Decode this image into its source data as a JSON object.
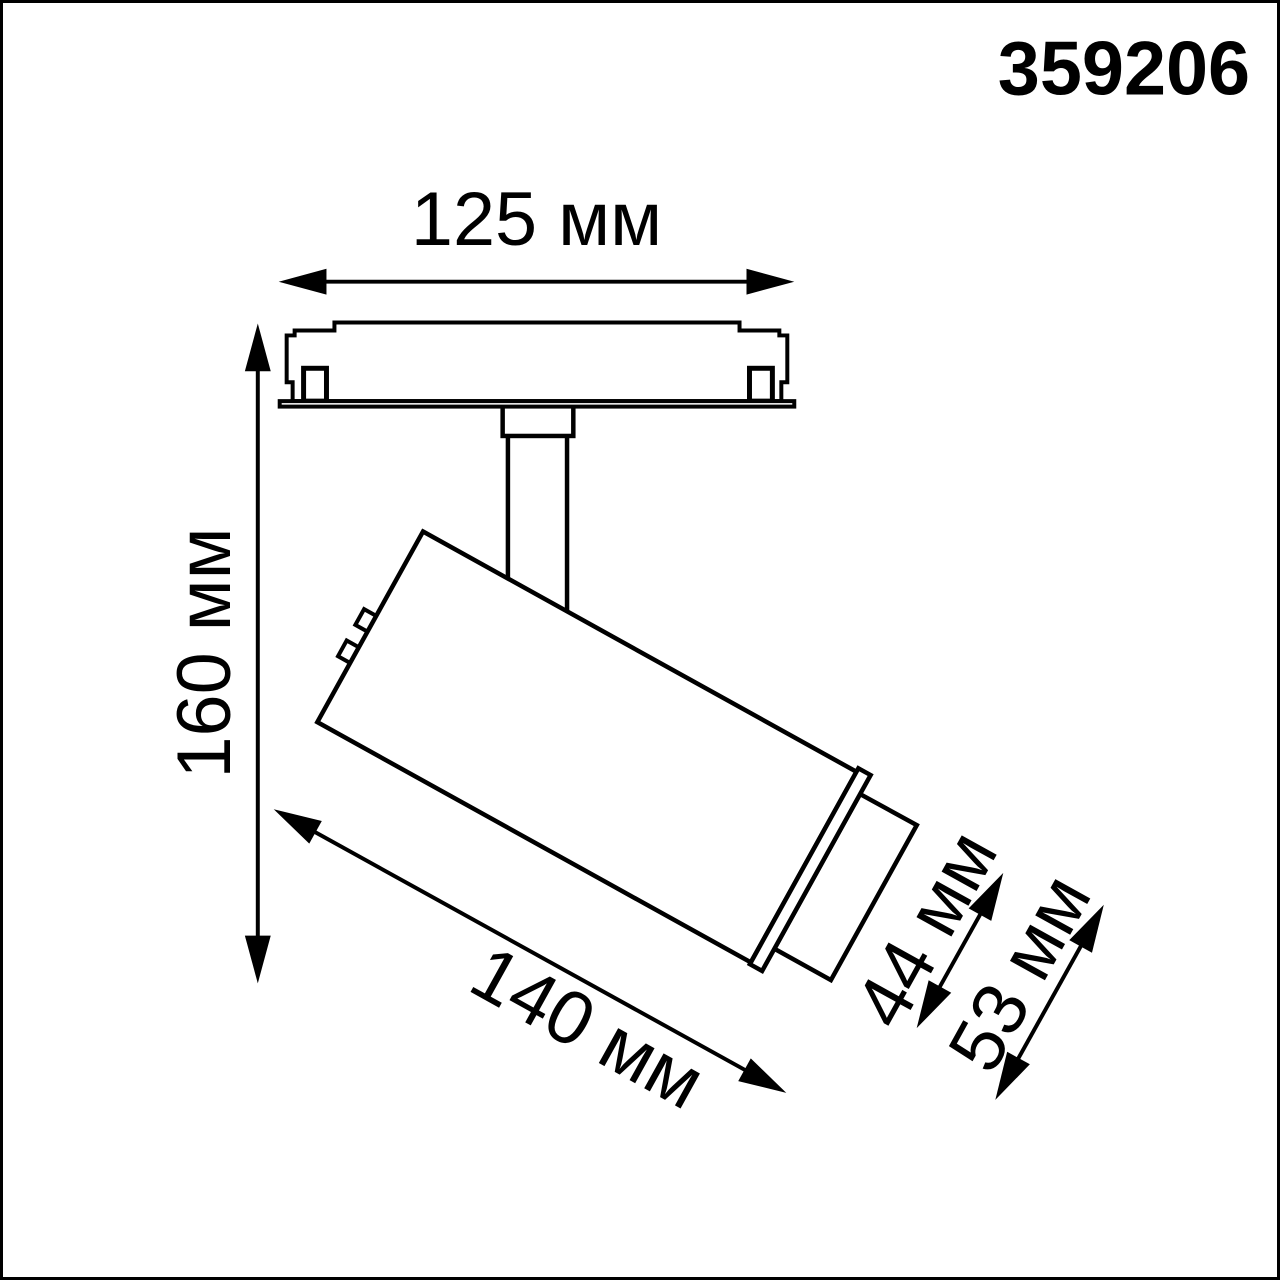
{
  "product_code": "359206",
  "drawing": {
    "kind": "technical-dimension-diagram",
    "subject": "track-light-fixture-side-view",
    "dimensions": [
      {
        "id": "track-adapter-width",
        "label": "125 мм",
        "value": 125,
        "unit": "мм"
      },
      {
        "id": "overall-height",
        "label": "160 мм",
        "value": 160,
        "unit": "мм"
      },
      {
        "id": "body-length",
        "label": "140 мм",
        "value": 140,
        "unit": "мм"
      },
      {
        "id": "head-diameter",
        "label": "44 мм",
        "value": 44,
        "unit": "мм"
      },
      {
        "id": "flange-diameter",
        "label": "53 мм",
        "value": 53,
        "unit": "мм"
      }
    ]
  },
  "colors": {
    "line": "#000000",
    "background": "#ffffff"
  }
}
